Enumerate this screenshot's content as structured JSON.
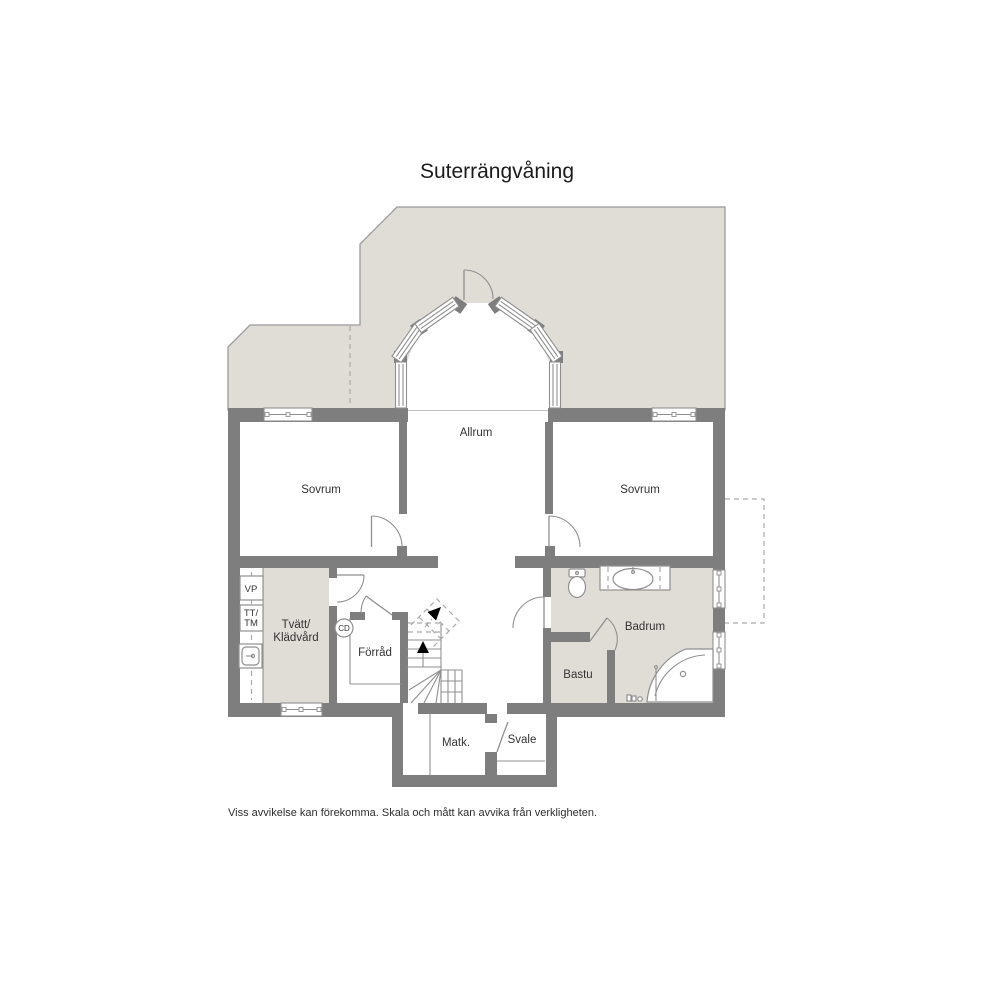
{
  "title": "Suterrängvåning",
  "footer": "Viss avvikelse kan förekomma. Skala och mått kan avvika från verkligheten.",
  "rooms": {
    "allrum": "Allrum",
    "sovrum_left": "Sovrum",
    "sovrum_right": "Sovrum",
    "tvatt_line1": "Tvätt/",
    "tvatt_line2": "Klädvård",
    "forrad": "Förråd",
    "badrum": "Badrum",
    "bastu": "Bastu",
    "matk": "Matk.",
    "svale": "Svale"
  },
  "fixtures": {
    "vp": "VP",
    "tt_line1": "TT/",
    "tt_line2": "TM",
    "cd": "CD"
  },
  "colors": {
    "wall": "#7e7e7e",
    "area": "#e0ddd7",
    "outline": "#9a9a9a",
    "line": "#8f8f8f",
    "dash": "#aaaaaa",
    "text": "#333333"
  }
}
